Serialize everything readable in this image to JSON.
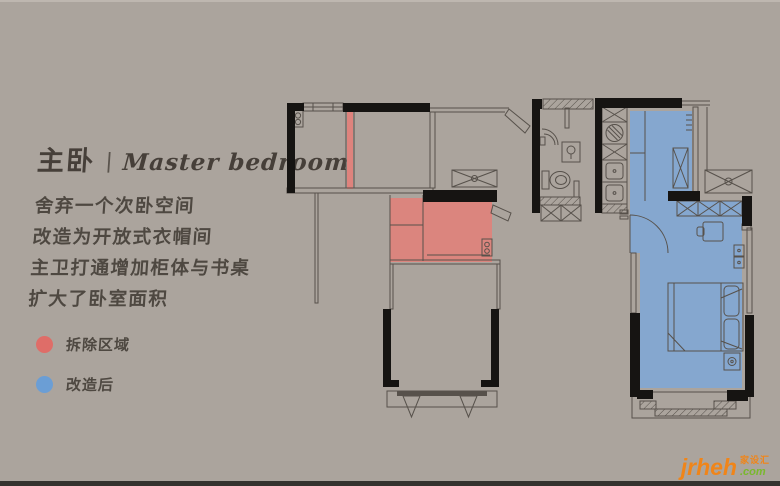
{
  "page": {
    "background": "#aba49d",
    "footer_bar_color": "#34322e"
  },
  "header": {
    "title_zh": "主卧",
    "separator": "|",
    "title_en": "Master bedroom"
  },
  "description": {
    "lines": [
      "舍弃一个次卧空间",
      "改造为开放式衣帽间",
      "主卫打通增加柜体与书桌",
      "扩大了卧室面积"
    ]
  },
  "legend": {
    "items": [
      {
        "label": "拆除区域",
        "color": "#df6d68"
      },
      {
        "label": "改造后",
        "color": "#6b9ed5"
      }
    ]
  },
  "colors": {
    "demolition_fill": "#e0827b",
    "renovated_fill": "#7fa7d6",
    "wall": "#161412",
    "line": "#57514b"
  },
  "watermark": {
    "brand": "jrheh",
    "cn": "家设汇",
    "tld": ".com"
  }
}
